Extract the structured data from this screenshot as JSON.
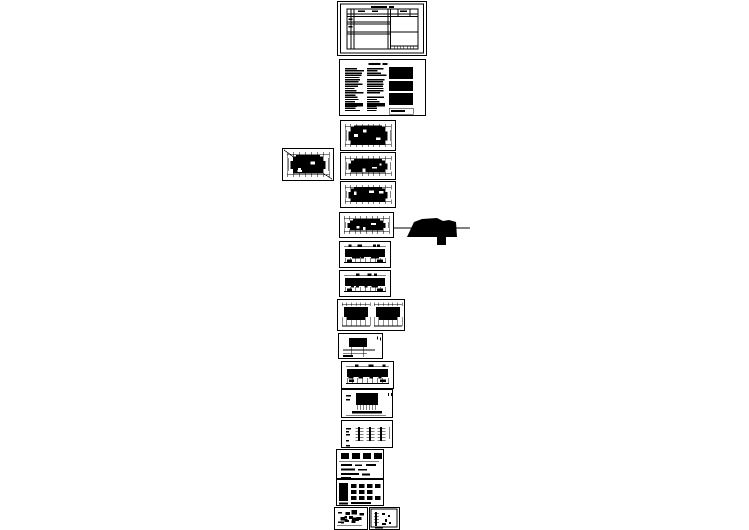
{
  "canvas": {
    "width": 749,
    "height": 530,
    "paper_color": "#ffffff",
    "ink_color": "#000000"
  },
  "sheets": [
    {
      "name": "sheet-drawing-index-table",
      "kind": "table",
      "x": 337,
      "y": 1,
      "w": 90,
      "h": 55,
      "seed": 1
    },
    {
      "name": "sheet-design-notes",
      "kind": "notes",
      "x": 339,
      "y": 59,
      "w": 87,
      "h": 57,
      "seed": 2
    },
    {
      "name": "sheet-floor-plan-1",
      "kind": "plan",
      "x": 340,
      "y": 120,
      "w": 56,
      "h": 31,
      "blob": 0.95,
      "seed": 3
    },
    {
      "name": "sheet-floor-plan-2",
      "kind": "plan",
      "x": 340,
      "y": 152,
      "w": 56,
      "h": 28,
      "blob": 0.68,
      "seed": 4
    },
    {
      "name": "sheet-floor-plan-3",
      "kind": "plan",
      "x": 340,
      "y": 181,
      "w": 56,
      "h": 27,
      "blob": 0.8,
      "seed": 5
    },
    {
      "name": "sheet-roof-plan",
      "kind": "plan",
      "x": 339,
      "y": 212,
      "w": 55,
      "h": 26,
      "blob": 0.55,
      "seed": 6
    },
    {
      "name": "sheet-elevation-1",
      "kind": "elevation",
      "x": 339,
      "y": 241,
      "w": 52,
      "h": 27,
      "seed": 7
    },
    {
      "name": "sheet-elevation-2",
      "kind": "elevation",
      "x": 339,
      "y": 270,
      "w": 52,
      "h": 27,
      "seed": 8
    },
    {
      "name": "sheet-sections",
      "kind": "sections",
      "x": 337,
      "y": 299,
      "w": 68,
      "h": 32,
      "seed": 9
    },
    {
      "name": "sheet-detail-1",
      "kind": "detailblob",
      "x": 338,
      "y": 333,
      "w": 45,
      "h": 26,
      "seed": 10
    },
    {
      "name": "sheet-elevation-3",
      "kind": "elevation",
      "x": 341,
      "y": 361,
      "w": 53,
      "h": 28,
      "seed": 11
    },
    {
      "name": "sheet-detail-2",
      "kind": "detailblob2",
      "x": 341,
      "y": 389,
      "w": 52,
      "h": 29,
      "seed": 12
    },
    {
      "name": "sheet-stair-details",
      "kind": "stairs",
      "x": 341,
      "y": 420,
      "w": 52,
      "h": 28,
      "seed": 13
    },
    {
      "name": "sheet-detail-blocks",
      "kind": "blocks",
      "x": 336,
      "y": 449,
      "w": 48,
      "h": 30,
      "seed": 14
    },
    {
      "name": "sheet-detail-legend",
      "kind": "legend",
      "x": 336,
      "y": 479,
      "w": 48,
      "h": 27,
      "seed": 15
    },
    {
      "name": "sheet-detail-dense",
      "kind": "dense",
      "x": 334,
      "y": 507,
      "w": 34,
      "h": 23,
      "seed": 16
    },
    {
      "name": "sheet-detail-panel",
      "kind": "panel",
      "x": 369,
      "y": 507,
      "w": 31,
      "h": 23,
      "seed": 17
    },
    {
      "name": "sheet-site-plan-left",
      "kind": "plan",
      "x": 282,
      "y": 148,
      "w": 52,
      "h": 33,
      "blob": 0.72,
      "diagonals": true,
      "seed": 18
    }
  ],
  "floating": {
    "name": "roof-section-silhouette",
    "x": 394,
    "y": 214,
    "w": 76,
    "h": 32,
    "leader_line_y": 14,
    "polygon_points": "13,23 20,8 28,5 43,4 49,7 55,6 62,8 63,23",
    "foot_rect": {
      "x": 43,
      "y": 23,
      "w": 9,
      "h": 8
    }
  }
}
